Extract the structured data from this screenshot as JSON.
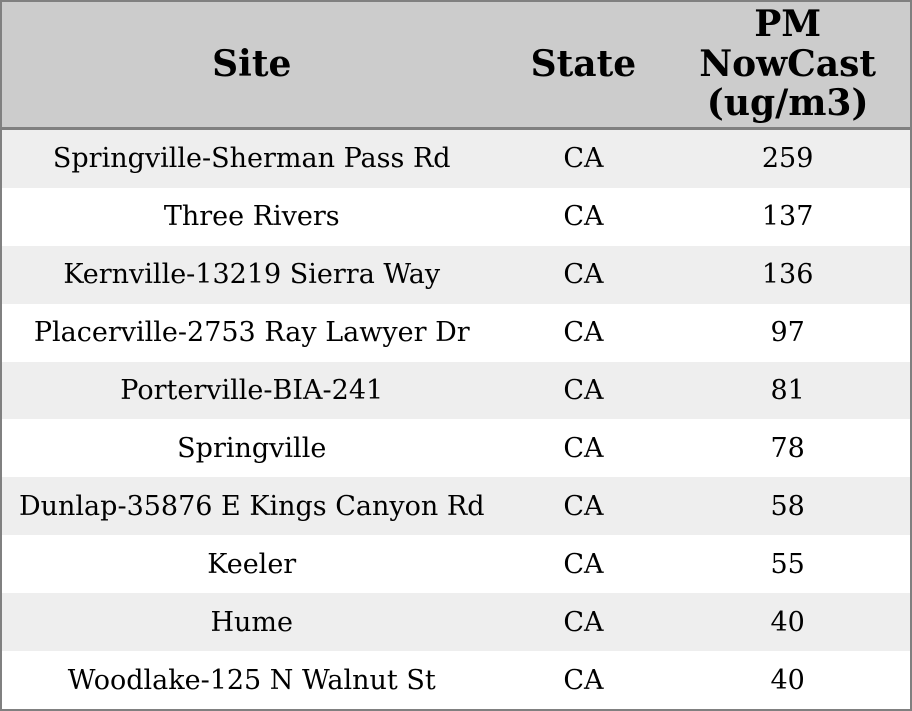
{
  "colors": {
    "header_bg": "#cccccc",
    "row_odd_bg": "#eeeeee",
    "row_even_bg": "#ffffff",
    "border": "#808080",
    "text": "#000000"
  },
  "chart_data": {
    "type": "table",
    "columns": [
      "Site",
      "State",
      "PM NowCast (ug/m3)"
    ],
    "rows": [
      {
        "site": "Springville-Sherman Pass Rd",
        "state": "CA",
        "pm": "259"
      },
      {
        "site": "Three Rivers",
        "state": "CA",
        "pm": "137"
      },
      {
        "site": "Kernville-13219 Sierra Way",
        "state": "CA",
        "pm": "136"
      },
      {
        "site": "Placerville-2753 Ray Lawyer Dr",
        "state": "CA",
        "pm": "97"
      },
      {
        "site": "Porterville-BIA-241",
        "state": "CA",
        "pm": "81"
      },
      {
        "site": "Springville",
        "state": "CA",
        "pm": "78"
      },
      {
        "site": "Dunlap-35876 E Kings Canyon Rd",
        "state": "CA",
        "pm": "58"
      },
      {
        "site": "Keeler",
        "state": "CA",
        "pm": "55"
      },
      {
        "site": "Hume",
        "state": "CA",
        "pm": "40"
      },
      {
        "site": "Woodlake-125 N Walnut St",
        "state": "CA",
        "pm": "40"
      }
    ]
  }
}
